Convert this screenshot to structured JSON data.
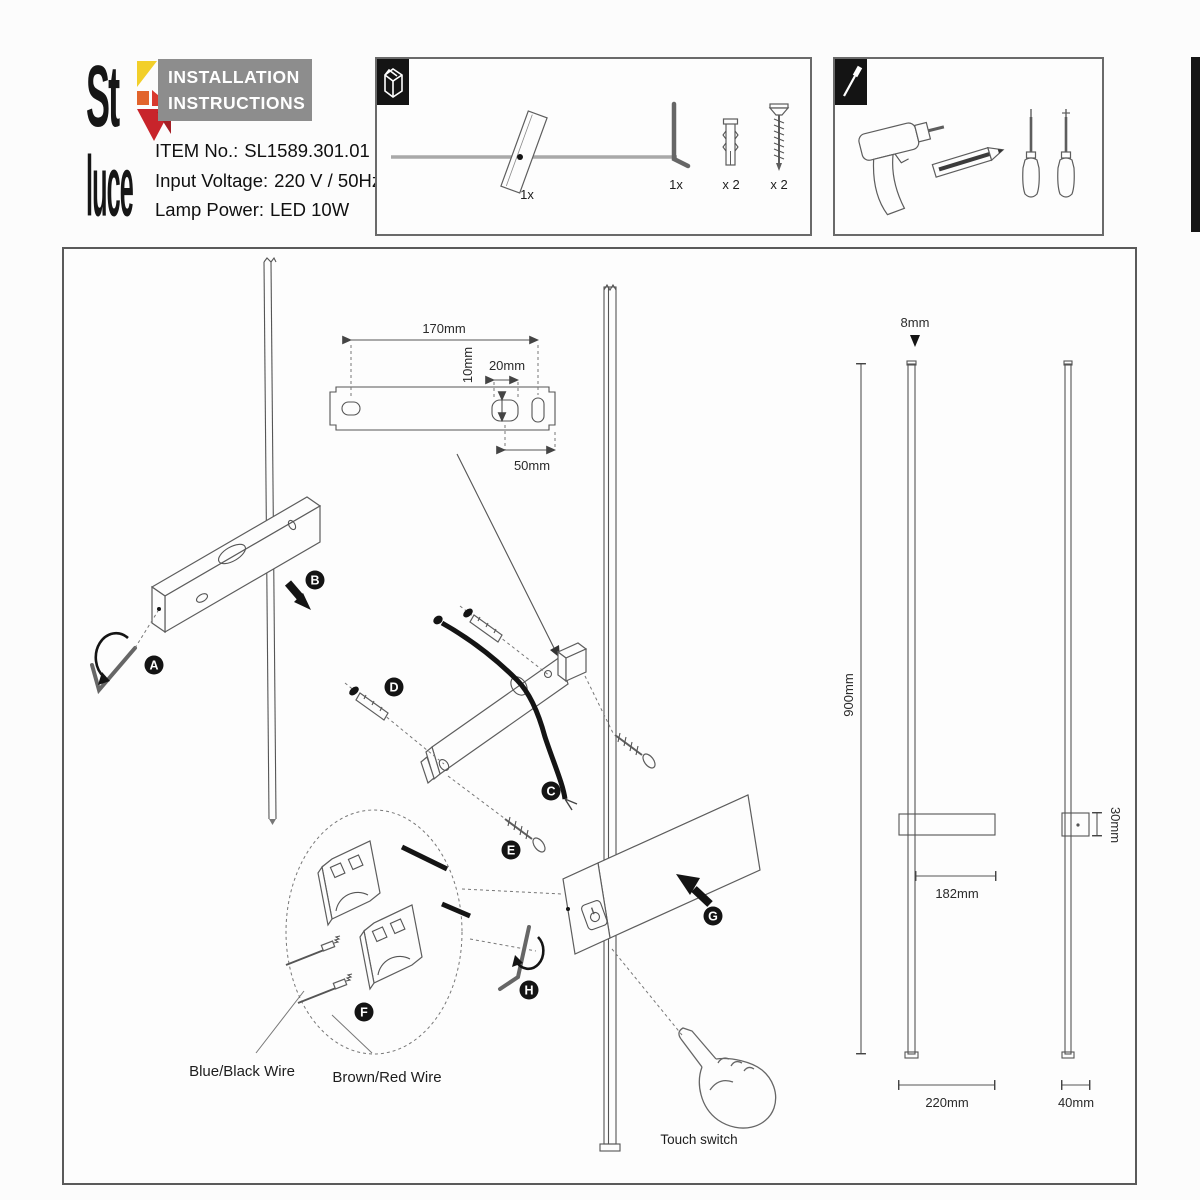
{
  "header": {
    "logo_line1": "St",
    "logo_line2": "luce",
    "banner_line1": "INSTALLATION",
    "banner_line2": "INSTRUCTIONS",
    "item_no_label": "ITEM No.:",
    "item_no_value": "SL1589.301.01",
    "voltage_label": "Input Voltage:",
    "voltage_value": "220 V / 50Hz",
    "power_label": "Lamp Power:",
    "power_value": "LED 10W"
  },
  "parts_box": {
    "lamp_qty": "1x",
    "hex_key_qty": "1x",
    "anchor_qty": "x 2",
    "screw_qty": "x 2"
  },
  "diagram": {
    "plate": {
      "width": "170mm",
      "hole_height": "10mm",
      "hole_width": "20mm",
      "hole_to_edge": "50mm"
    },
    "steps": {
      "a": "A",
      "b": "B",
      "c": "C",
      "d": "D",
      "e": "E",
      "f": "F",
      "g": "G",
      "h": "H"
    },
    "wire_left": "Blue/Black Wire",
    "wire_right": "Brown/Red Wire",
    "touch_switch": "Touch switch",
    "dims": {
      "diameter": "8mm",
      "height": "900mm",
      "body_width": "182mm",
      "overall_width": "220mm",
      "depth": "40mm",
      "body_height": "30mm"
    }
  }
}
